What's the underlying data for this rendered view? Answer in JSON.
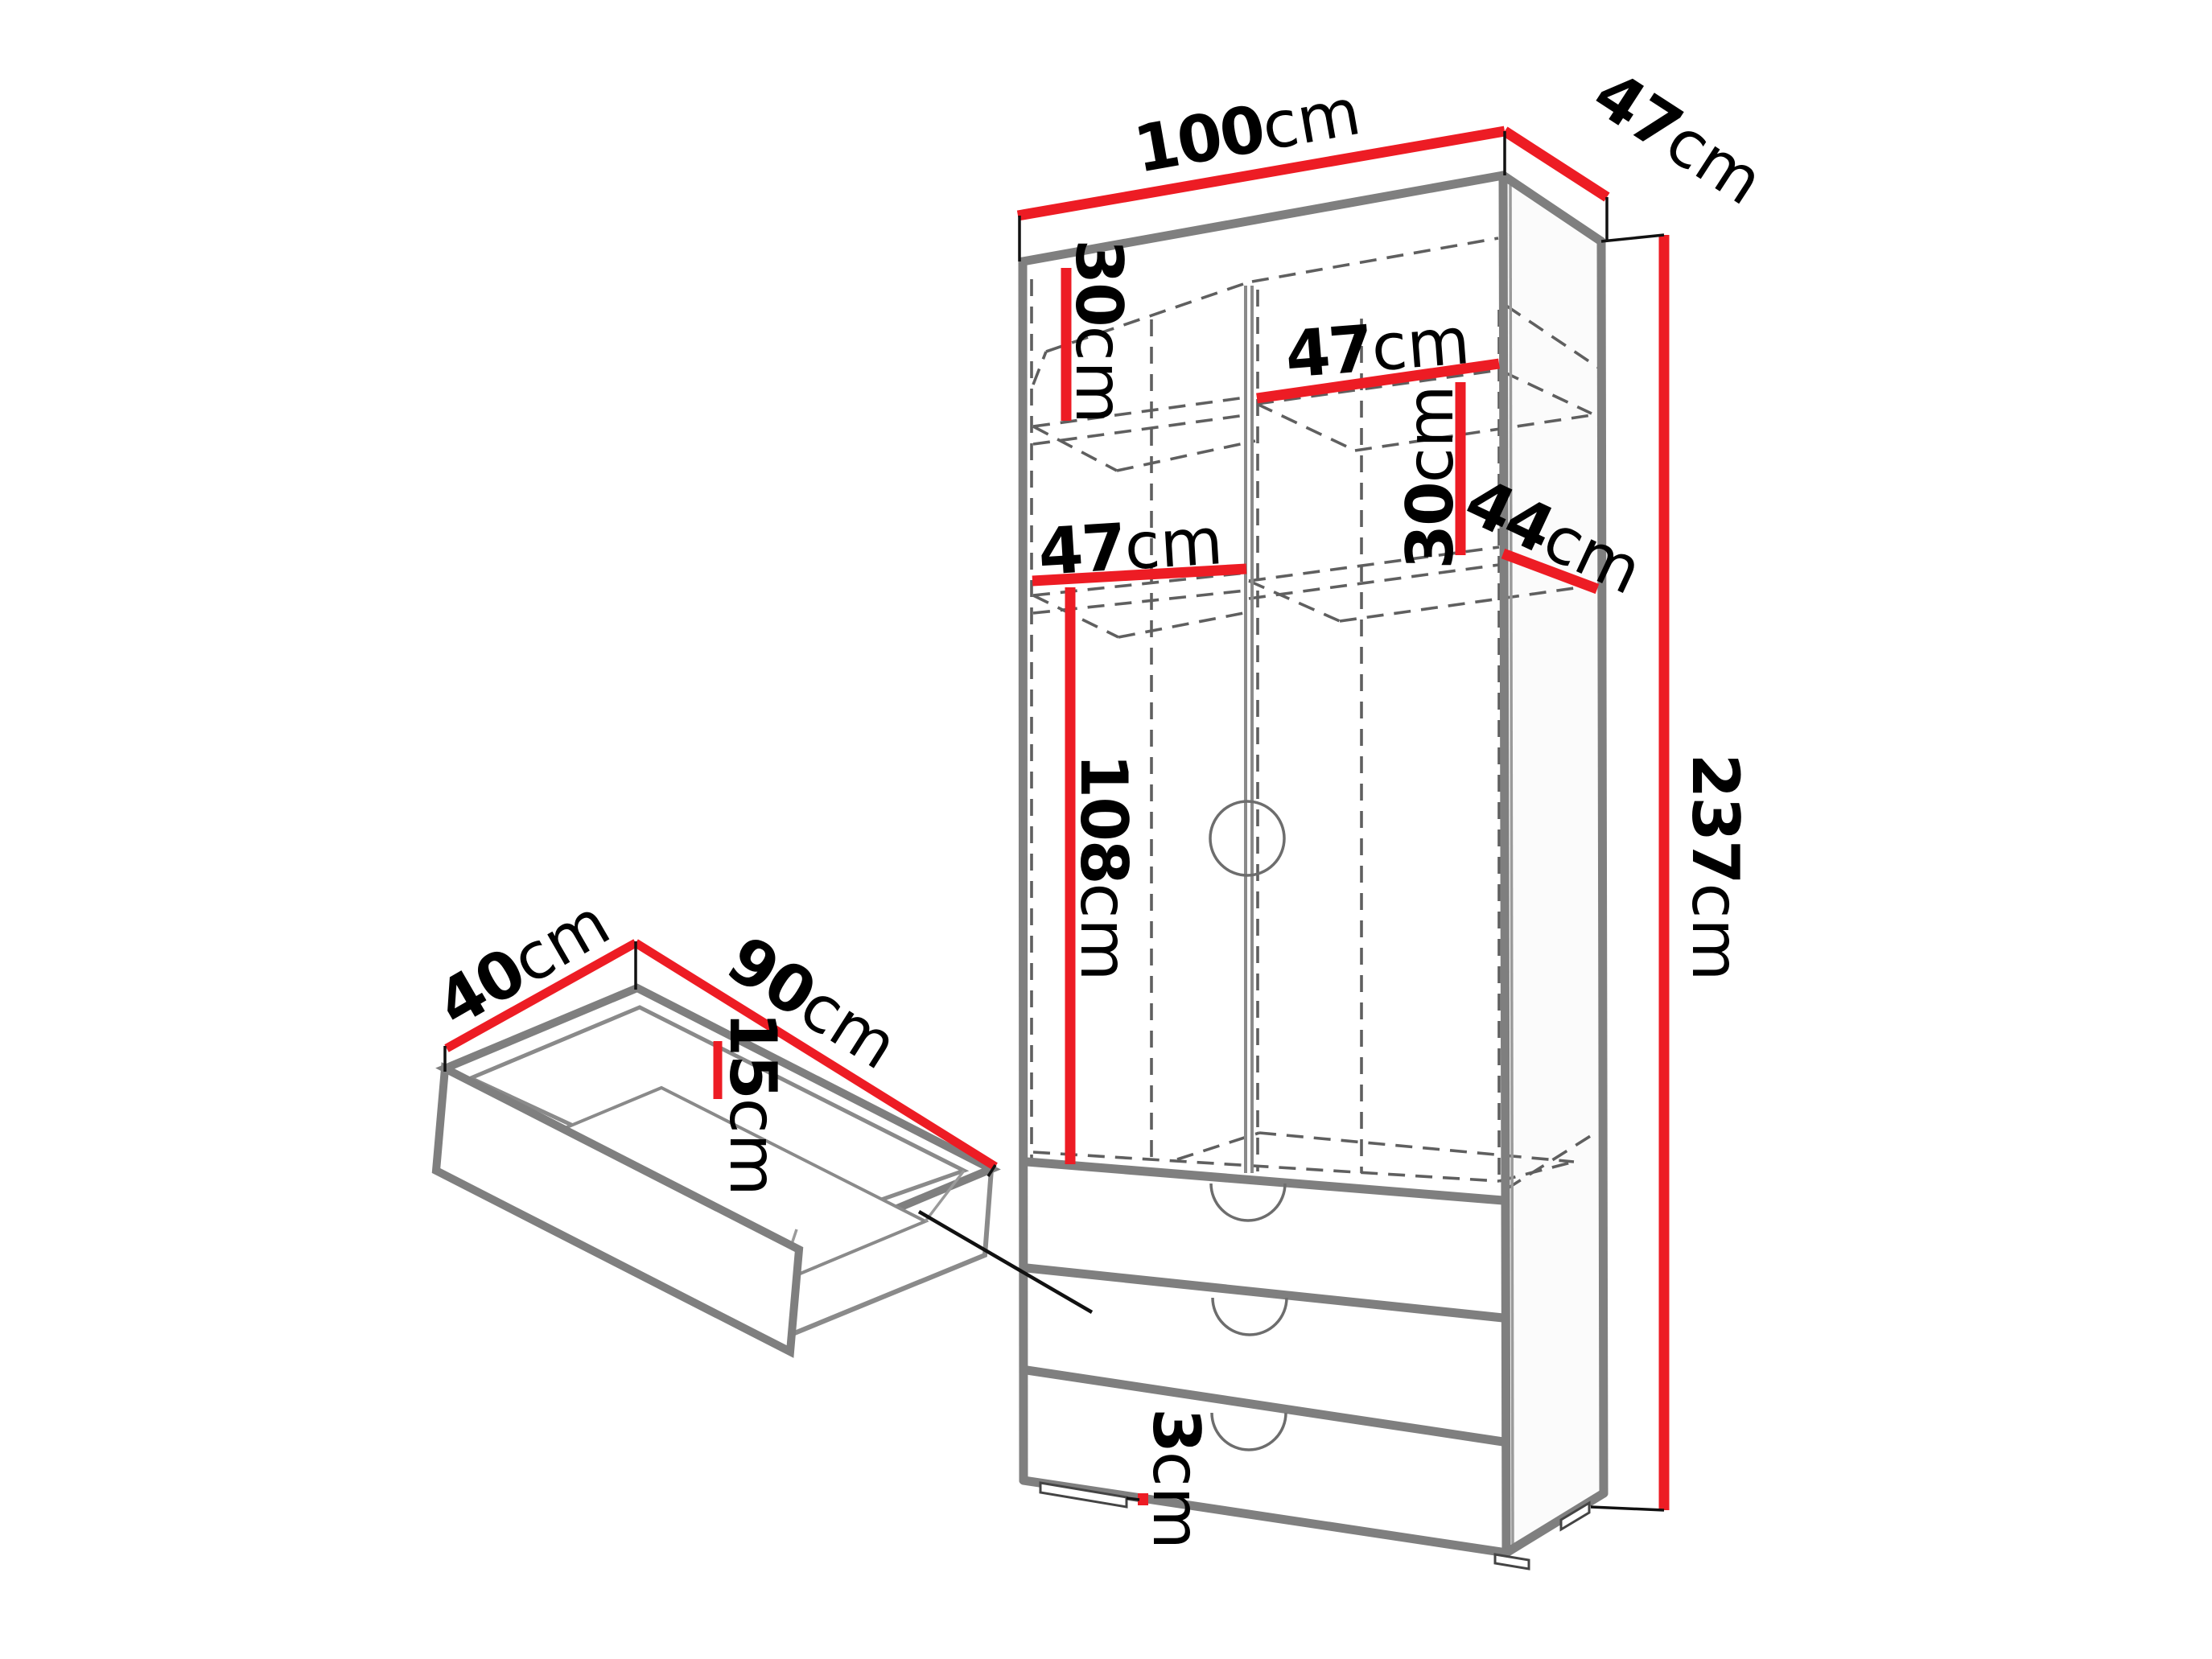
{
  "diagram": {
    "kind": "furniture-dimension-diagram",
    "subject": "wardrobe-with-drawers-and-detached-drawer-detail",
    "unit": "cm"
  },
  "dims": {
    "top_width": {
      "value": "100",
      "unit": "cm"
    },
    "top_depth": {
      "value": "47",
      "unit": "cm"
    },
    "upper_left_height": {
      "value": "30",
      "unit": "cm"
    },
    "upper_right_width": {
      "value": "47",
      "unit": "cm"
    },
    "upper_right_height": {
      "value": "30",
      "unit": "cm"
    },
    "side_depth": {
      "value": "44",
      "unit": "cm"
    },
    "mid_left_width": {
      "value": "47",
      "unit": "cm"
    },
    "mid_left_height": {
      "value": "108",
      "unit": "cm"
    },
    "total_height": {
      "value": "237",
      "unit": "cm"
    },
    "plinth_height": {
      "value": "3",
      "unit": "cm"
    }
  },
  "drawer": {
    "depth": {
      "value": "40",
      "unit": "cm"
    },
    "width": {
      "value": "90",
      "unit": "cm"
    },
    "height": {
      "value": "15",
      "unit": "cm"
    }
  },
  "colors": {
    "dimension": "#ed1c24",
    "outline": "#7f7f7f",
    "hidden": "#5f5f5f",
    "text": "#000000",
    "background": "#ffffff"
  }
}
